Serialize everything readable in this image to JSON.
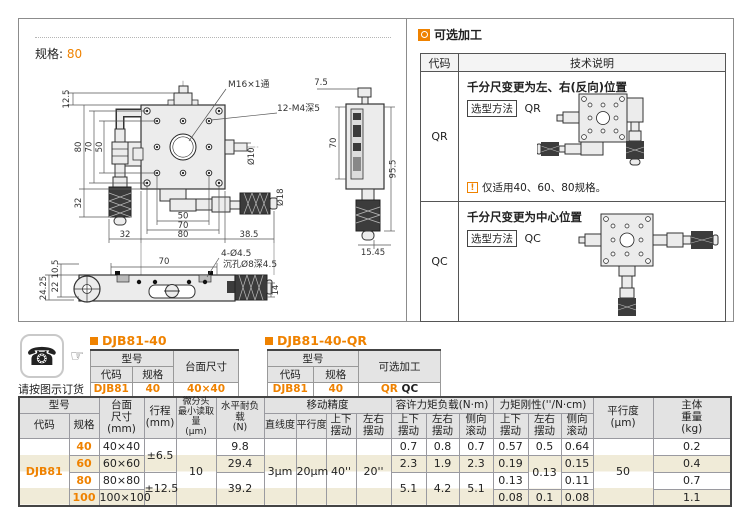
{
  "colors": {
    "accent": "#ef8200",
    "stripe": "#f0ebd8",
    "header_bg": "#e3e3e3"
  },
  "icons": {
    "phone": "☎",
    "pointer": "☞",
    "alert": "!"
  },
  "left_panel": {
    "spec_label": "规格:",
    "spec_value": "80",
    "drawing": {
      "d125": "12.5",
      "d80": "80",
      "d70": "70",
      "d50": "50",
      "d32": "32",
      "b50": "50",
      "b70": "70",
      "b80": "80",
      "b32": "32",
      "b385": "38.5",
      "m16": "M16×1通",
      "m4": "12-M4深5",
      "o10": "Ø10",
      "o18": "Ø18",
      "s75": "7.5",
      "s70": "70",
      "s955": "95.5",
      "s1545": "15.45",
      "v70": "70",
      "v445": "4-Ø4.5",
      "vsink": "沉孔Ø8深4.5",
      "v105": "10.5",
      "v2425": "24.25",
      "v22": "22",
      "v14": "14"
    }
  },
  "optional": {
    "title": "可选加工",
    "col_code": "代码",
    "col_desc": "技术说明",
    "qr": {
      "code": "QR",
      "title": "千分尺变更为左、右(反向)位置",
      "method_label": "选型方法",
      "method_value": "QR",
      "note": "仅适用40、60、80规格。"
    },
    "qc": {
      "code": "QC",
      "title": "千分尺变更为中心位置",
      "method_label": "选型方法",
      "method_value": "QC"
    }
  },
  "order": {
    "caption": "请按图示订货",
    "t1": {
      "title": "DJB81-40",
      "h_model": "型号",
      "h_code": "代码",
      "h_spec": "规格",
      "h_extra": "台面尺寸",
      "code": "DJB81",
      "spec": "40",
      "extra": "40×40"
    },
    "t2": {
      "title": "DJB81-40-QR",
      "h_model": "型号",
      "h_code": "代码",
      "h_spec": "规格",
      "h_extra": "可选加工",
      "code": "DJB81",
      "spec": "40",
      "extra_a": "QR",
      "extra_b": "QC"
    }
  },
  "spec_table": {
    "h_model": "型号",
    "h_code": "代码",
    "h_spec": "规格",
    "h_surface": "台面\n尺寸\n(mm)",
    "h_travel": "行程\n(mm)",
    "h_micro": "微分头\n最小读取量\n(μm)",
    "h_load": "水平耐负载\n(N)",
    "h_accuracy": "移动精度",
    "h_line": "直线度",
    "h_para": "平行度",
    "h_pitch": "上下\n摆动",
    "h_yaw": "左右\n摆动",
    "h_moment": "容许力矩负载(N·m)",
    "h_mu": "上下\n摆动",
    "h_ml": "左右\n摆动",
    "h_mr": "侧向\n滚动",
    "h_rigid": "力矩刚性(''/N·cm)",
    "h_su": "上下\n摆动",
    "h_sl": "左右\n摆动",
    "h_sr": "侧向\n滚动",
    "h_parallel": "平行度\n(μm)",
    "h_weight": "主体\n重量\n(kg)",
    "code": "DJB81",
    "r1": {
      "spec": "40",
      "surface": "40×40",
      "load": "9.8",
      "mu": "0.7",
      "ml": "0.8",
      "mr": "0.7",
      "su": "0.57",
      "sl": "0.5",
      "sr": "0.64",
      "wt": "0.2"
    },
    "r2": {
      "spec": "60",
      "surface": "60×60",
      "load": "29.4",
      "mu": "2.3",
      "ml": "1.9",
      "mr": "2.3",
      "su": "0.19",
      "sr": "0.15",
      "wt": "0.4"
    },
    "r3": {
      "spec": "80",
      "surface": "80×80",
      "su": "0.13",
      "sr": "0.11",
      "wt": "0.7"
    },
    "r4": {
      "spec": "100",
      "surface": "100×100",
      "su": "0.08",
      "sl": "0.1",
      "sr": "0.08",
      "wt": "1.1"
    },
    "travel12": "±6.5",
    "travel34": "±12.5",
    "micro": "10",
    "load34": "39.2",
    "line": "3μm",
    "para": "20μm",
    "pitch": "40''",
    "yaw": "20''",
    "mu34": "5.1",
    "ml34": "4.2",
    "mr34": "5.1",
    "sl23": "0.13",
    "parallel": "50"
  }
}
